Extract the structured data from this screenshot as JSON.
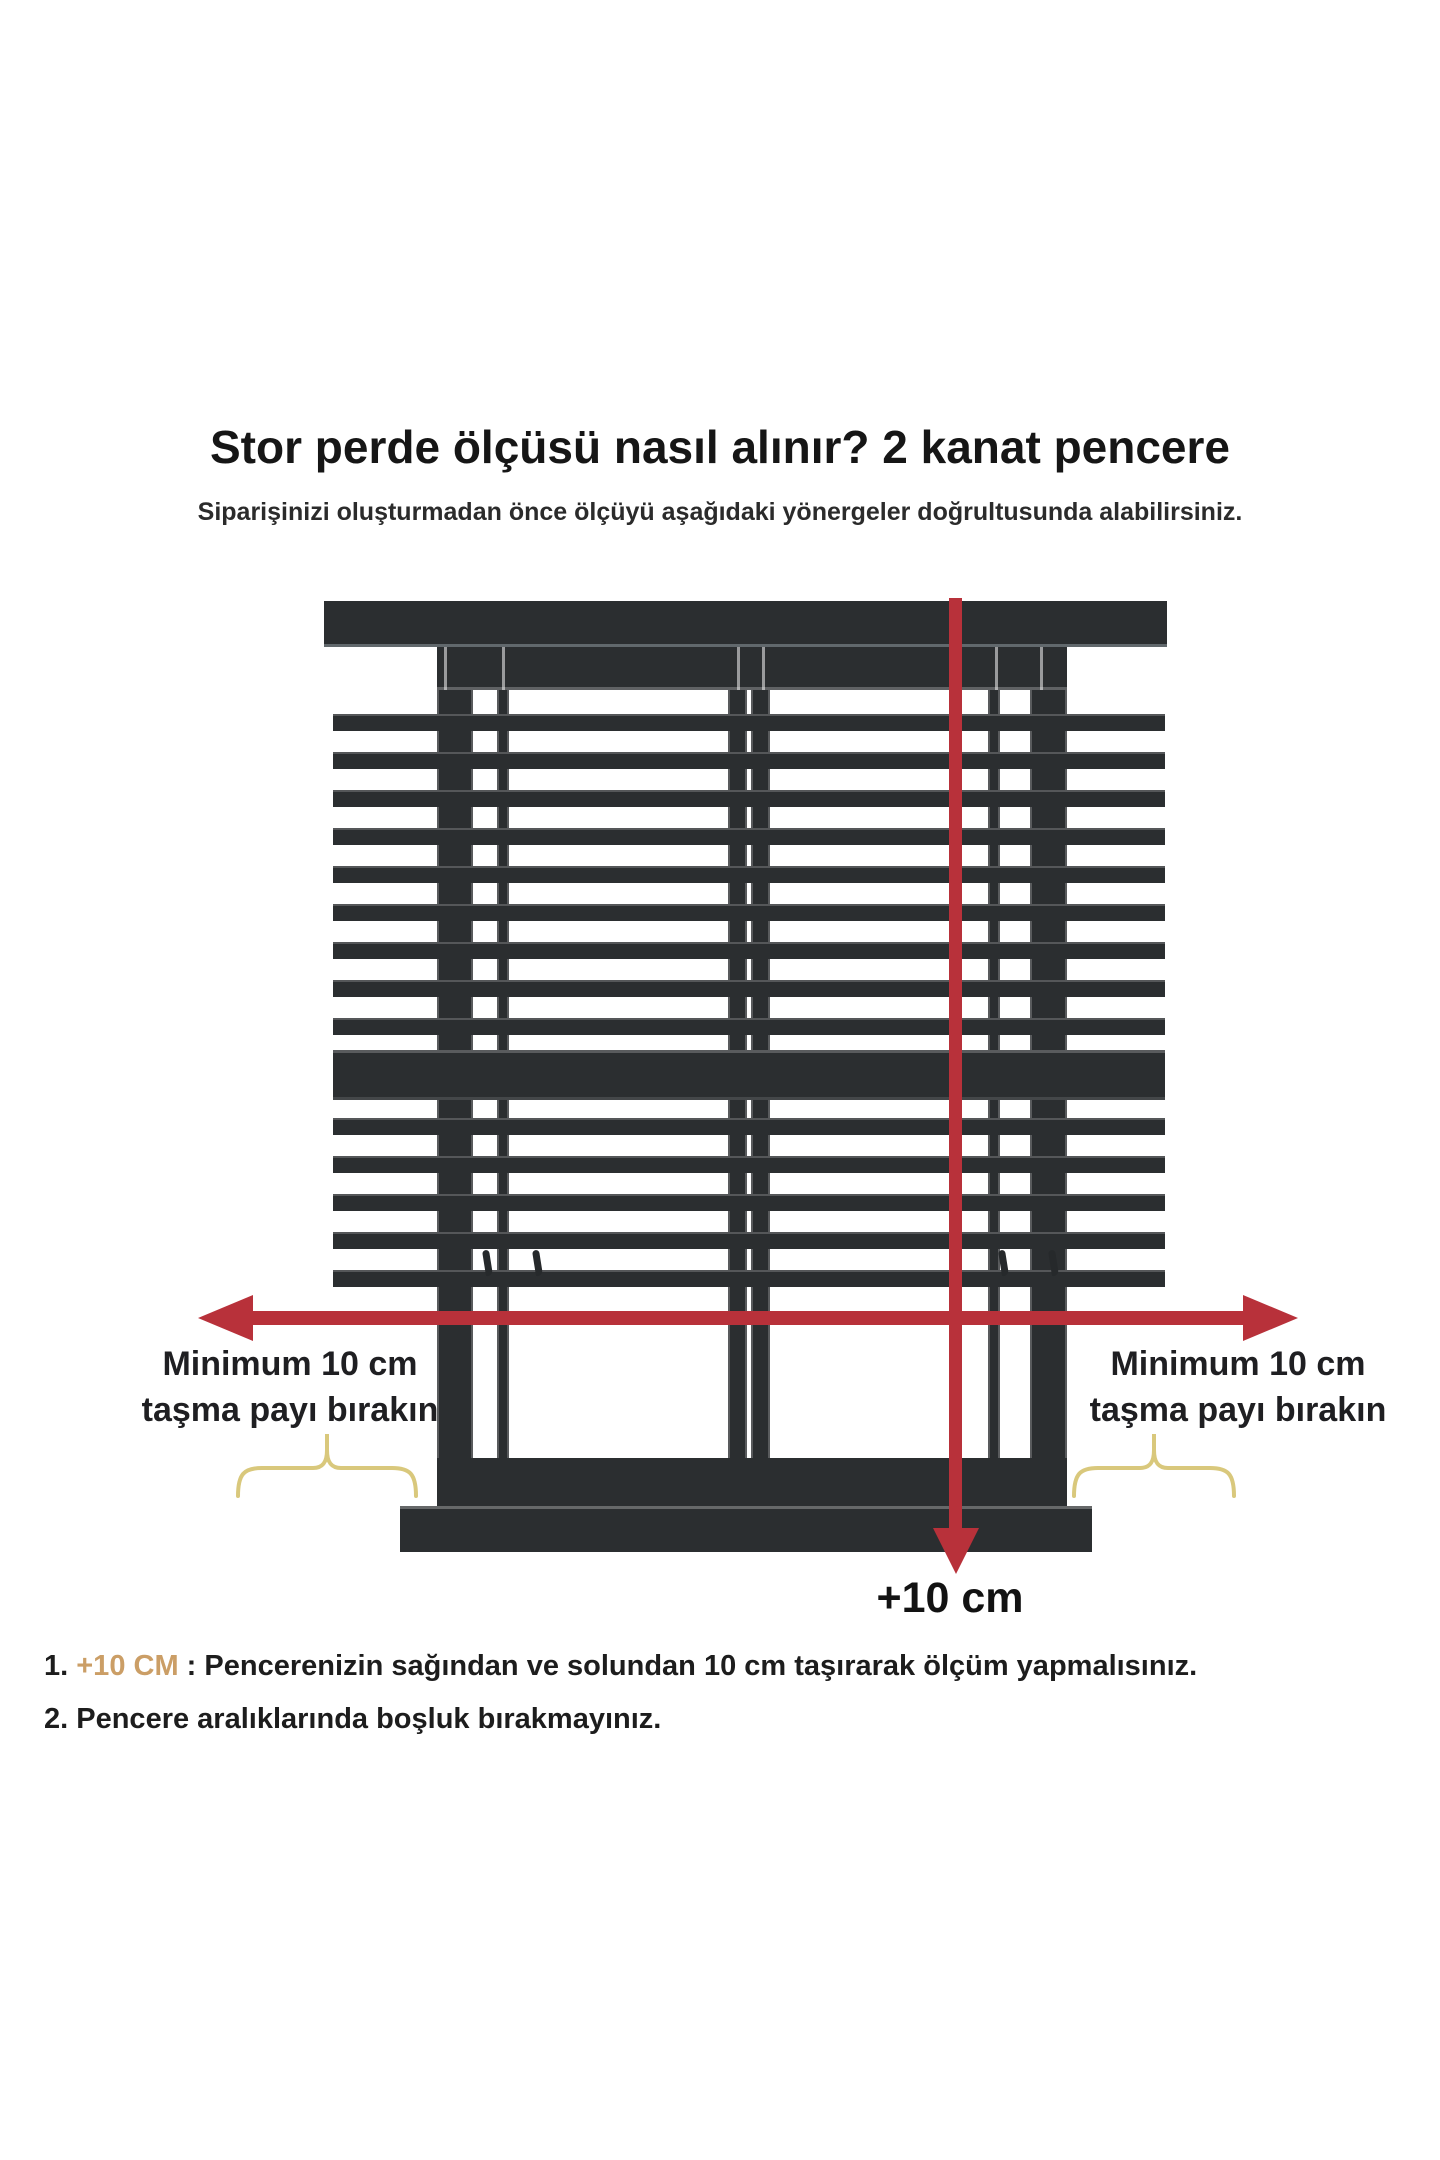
{
  "header": {
    "title": "Stor perde ölçüsü nasıl alınır? 2 kanat pencere",
    "subtitle": "Siparişinizi oluşturmadan önce ölçüyü aşağıdaki yönergeler doğrultusunda alabilirsiniz."
  },
  "diagram": {
    "left_label": {
      "line1": "Minimum 10 cm",
      "line2": "taşma payı bırakın"
    },
    "right_label": {
      "line1": "Minimum 10 cm",
      "line2": "taşma payı bırakın"
    },
    "bottom_arrow_label": "+10 cm",
    "colors": {
      "arrow_red": "#b8313a",
      "frame_dark": "#2b2e30",
      "brace_yellow": "#d9c87c",
      "highlight_tan": "#cb9e66"
    }
  },
  "instructions": {
    "item1": {
      "number": "1.",
      "highlight": "+10 CM",
      "text": ": Pencerenizin sağından ve solundan 10 cm taşırarak ölçüm yapmalısınız."
    },
    "item2": {
      "number": "2.",
      "text": "Pencere aralıklarında boşluk bırakmayınız."
    }
  }
}
